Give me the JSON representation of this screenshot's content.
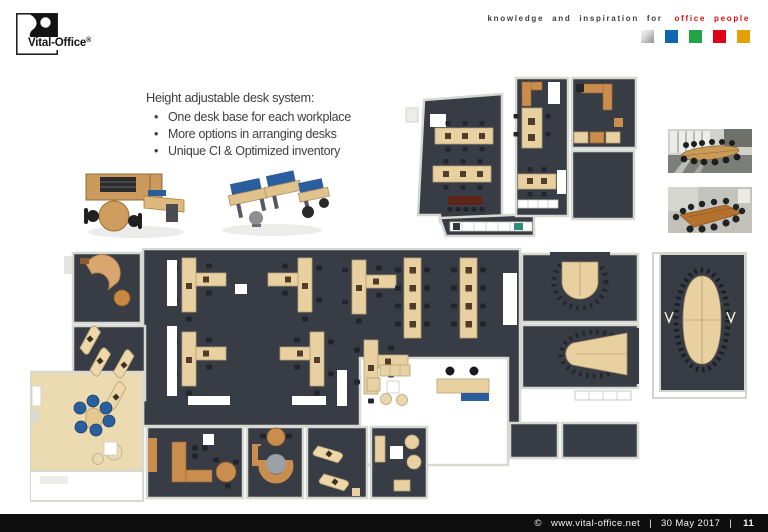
{
  "slide": {
    "logo": {
      "name": "Vital-Office",
      "registered_mark": "®"
    },
    "tagline": {
      "prefix": "knowledge and inspiration for",
      "highlight": "office people",
      "highlight_color": "#e30613"
    },
    "brand_squares": [
      {
        "name": "silver",
        "color": "#b9b9b9"
      },
      {
        "name": "blue",
        "color": "#1266b0"
      },
      {
        "name": "green",
        "color": "#22a347"
      },
      {
        "name": "red",
        "color": "#e00018"
      },
      {
        "name": "amber",
        "color": "#e3a008"
      }
    ],
    "content": {
      "headline": "Height adjustable desk system:",
      "bullet_char": "•",
      "bullets": [
        "One desk base for each workplace",
        "More options in arranging desks",
        "Unique CI & Optimized inventory"
      ]
    },
    "figures": {
      "render_left": "3D render - executive desk with sideboard and round meeting table",
      "render_right": "3D render - team desk cluster with blue acoustic screens",
      "floorplan_top": "floor plan - upper office wing with bench desks",
      "floorplan_main": "floor plan - main office level with open space, lobby and meeting rooms",
      "floorplan_side": "floor plan - boardroom with large oval conference table",
      "photo_top": "photo - conference room with long oval table",
      "photo_bottom": "photo - conference room with rectangular table"
    },
    "palette": {
      "plan_floor_dark": "#383c44",
      "plan_desk_beige": "#e9d0a1",
      "plan_wood_orange": "#c98d4e",
      "plan_accent_blue": "#2a5d9c",
      "plan_floor_light": "#ecdbb1",
      "plan_wall_gray": "#d8d8d3"
    },
    "footer": {
      "copyright_symbol": "©",
      "website": "www.vital-office.net",
      "separator": "|",
      "date": "30 May 2017",
      "page_number": "11"
    }
  }
}
